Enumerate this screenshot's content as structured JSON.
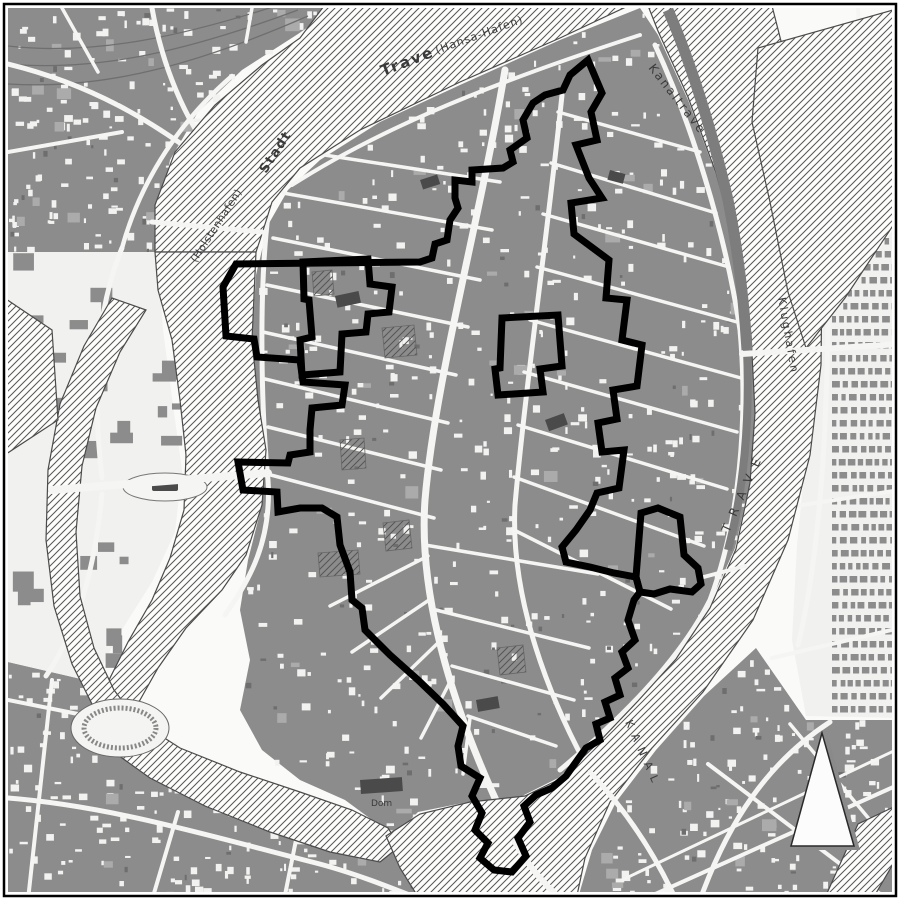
{
  "labels": [
    {
      "id": "trave",
      "text": "Trave",
      "x": 383,
      "y": 76,
      "rot": -21,
      "size": 15,
      "ls": 2,
      "weight": "bold"
    },
    {
      "id": "hansahafen",
      "text": "(Hansa-Hafen)",
      "x": 437,
      "y": 54,
      "rot": -20,
      "size": 11,
      "ls": 1,
      "weight": "normal"
    },
    {
      "id": "stadt",
      "text": "Stadt",
      "x": 266,
      "y": 174,
      "rot": -57,
      "size": 13,
      "ls": 1.5,
      "weight": "bold"
    },
    {
      "id": "holstenhafen",
      "text": "(Holstenhafen)",
      "x": 196,
      "y": 263,
      "rot": -57,
      "size": 10.5,
      "ls": 0.5,
      "weight": "normal"
    },
    {
      "id": "kanaltrave",
      "text": "Kanaltrave",
      "x": 648,
      "y": 68,
      "rot": 52,
      "size": 12,
      "ls": 2,
      "weight": "normal"
    },
    {
      "id": "klughafen",
      "text": "Klughafen",
      "x": 778,
      "y": 298,
      "rot": 80,
      "size": 11,
      "ls": 2.5,
      "weight": "normal"
    },
    {
      "id": "trave-east",
      "text": "T R A V E",
      "x": 729,
      "y": 533,
      "rot": -66,
      "size": 12,
      "ls": 3,
      "weight": "normal"
    },
    {
      "id": "kanal",
      "text": "K A N A L",
      "x": 625,
      "y": 722,
      "rot": 66,
      "size": 11,
      "ls": 2,
      "weight": "normal"
    },
    {
      "id": "dom",
      "text": "Dom",
      "x": 371,
      "y": 806,
      "rot": 0,
      "size": 9,
      "ls": 0,
      "weight": "normal"
    }
  ],
  "boundary": {
    "main": [
      [
        588,
        60
      ],
      [
        602,
        93
      ],
      [
        591,
        112
      ],
      [
        597,
        140
      ],
      [
        576,
        145
      ],
      [
        589,
        178
      ],
      [
        602,
        198
      ],
      [
        571,
        203
      ],
      [
        574,
        234
      ],
      [
        609,
        260
      ],
      [
        606,
        298
      ],
      [
        627,
        300
      ],
      [
        622,
        340
      ],
      [
        642,
        345
      ],
      [
        637,
        386
      ],
      [
        613,
        390
      ],
      [
        617,
        419
      ],
      [
        598,
        423
      ],
      [
        602,
        452
      ],
      [
        624,
        450
      ],
      [
        619,
        488
      ],
      [
        597,
        493
      ],
      [
        590,
        510
      ],
      [
        576,
        530
      ],
      [
        562,
        547
      ],
      [
        566,
        562
      ],
      [
        590,
        567
      ],
      [
        614,
        573
      ],
      [
        636,
        577
      ],
      [
        640,
        592
      ],
      [
        634,
        600
      ],
      [
        628,
        620
      ],
      [
        635,
        640
      ],
      [
        622,
        652
      ],
      [
        628,
        668
      ],
      [
        615,
        678
      ],
      [
        620,
        695
      ],
      [
        605,
        702
      ],
      [
        610,
        718
      ],
      [
        596,
        724
      ],
      [
        600,
        740
      ],
      [
        586,
        748
      ],
      [
        576,
        762
      ],
      [
        566,
        776
      ],
      [
        552,
        788
      ],
      [
        536,
        795
      ],
      [
        524,
        806
      ],
      [
        530,
        822
      ],
      [
        518,
        838
      ],
      [
        526,
        856
      ],
      [
        512,
        872
      ],
      [
        494,
        870
      ],
      [
        480,
        858
      ],
      [
        488,
        843
      ],
      [
        475,
        830
      ],
      [
        482,
        813
      ],
      [
        472,
        796
      ],
      [
        480,
        778
      ],
      [
        461,
        766
      ],
      [
        458,
        746
      ],
      [
        463,
        726
      ],
      [
        443,
        704
      ],
      [
        418,
        680
      ],
      [
        390,
        655
      ],
      [
        365,
        630
      ],
      [
        362,
        608
      ],
      [
        352,
        600
      ],
      [
        350,
        572
      ],
      [
        340,
        545
      ],
      [
        337,
        517
      ],
      [
        322,
        508
      ],
      [
        300,
        508
      ],
      [
        278,
        512
      ],
      [
        277,
        492
      ],
      [
        243,
        490
      ],
      [
        238,
        462
      ],
      [
        288,
        463
      ],
      [
        290,
        455
      ],
      [
        310,
        452
      ],
      [
        310,
        430
      ],
      [
        312,
        408
      ],
      [
        342,
        405
      ],
      [
        345,
        385
      ],
      [
        303,
        382
      ],
      [
        300,
        360
      ],
      [
        257,
        357
      ],
      [
        254,
        339
      ],
      [
        226,
        336
      ],
      [
        223,
        287
      ],
      [
        236,
        264
      ],
      [
        420,
        262
      ],
      [
        432,
        258
      ],
      [
        435,
        244
      ],
      [
        447,
        240
      ],
      [
        450,
        220
      ],
      [
        458,
        208
      ],
      [
        455,
        198
      ],
      [
        455,
        180
      ],
      [
        472,
        182
      ],
      [
        472,
        170
      ],
      [
        503,
        168
      ],
      [
        513,
        162
      ],
      [
        510,
        150
      ],
      [
        527,
        138
      ],
      [
        523,
        120
      ],
      [
        533,
        103
      ],
      [
        545,
        95
      ],
      [
        563,
        90
      ],
      [
        570,
        75
      ]
    ],
    "inner": [
      [
        303,
        262
      ],
      [
        368,
        259
      ],
      [
        370,
        284
      ],
      [
        392,
        287
      ],
      [
        389,
        312
      ],
      [
        368,
        314
      ],
      [
        366,
        332
      ],
      [
        342,
        334
      ],
      [
        340,
        372
      ],
      [
        302,
        375
      ],
      [
        300,
        340
      ],
      [
        312,
        337
      ],
      [
        309,
        300
      ],
      [
        304,
        299
      ]
    ],
    "middle": [
      [
        502,
        318
      ],
      [
        558,
        315
      ],
      [
        562,
        366
      ],
      [
        540,
        369
      ],
      [
        543,
        392
      ],
      [
        498,
        395
      ],
      [
        495,
        369
      ],
      [
        500,
        368
      ]
    ],
    "east_bulge": [
      [
        636,
        577
      ],
      [
        641,
        513
      ],
      [
        658,
        508
      ],
      [
        680,
        517
      ],
      [
        684,
        555
      ],
      [
        698,
        568
      ],
      [
        701,
        584
      ],
      [
        692,
        592
      ],
      [
        670,
        589
      ],
      [
        654,
        594
      ],
      [
        640,
        592
      ]
    ]
  },
  "north_arrow": {
    "apex": [
      822,
      733
    ],
    "base_left": [
      791,
      846
    ],
    "base_right": [
      854,
      846
    ],
    "shadow_dx": 6,
    "shadow_dy": 4
  },
  "colors": {
    "background": "#fafaf8",
    "building": "#8c8c8c",
    "building_dark": "#4a4a4a",
    "building_light": "#ababab",
    "street": "#f5f5f3",
    "water_fill": "#fdfdfc",
    "water_outline": "#4a4a4a",
    "hatch_line": "#555555",
    "canal_fill": "#7d7d7d",
    "boundary": "#000000",
    "label": "#3a3a3a",
    "rail": "#6f6f6f",
    "arrow_fill": "#fcfcfc",
    "arrow_shadow": "#8a8a8a",
    "arrow_outline": "#2a2a2a",
    "frame": "#000000"
  }
}
